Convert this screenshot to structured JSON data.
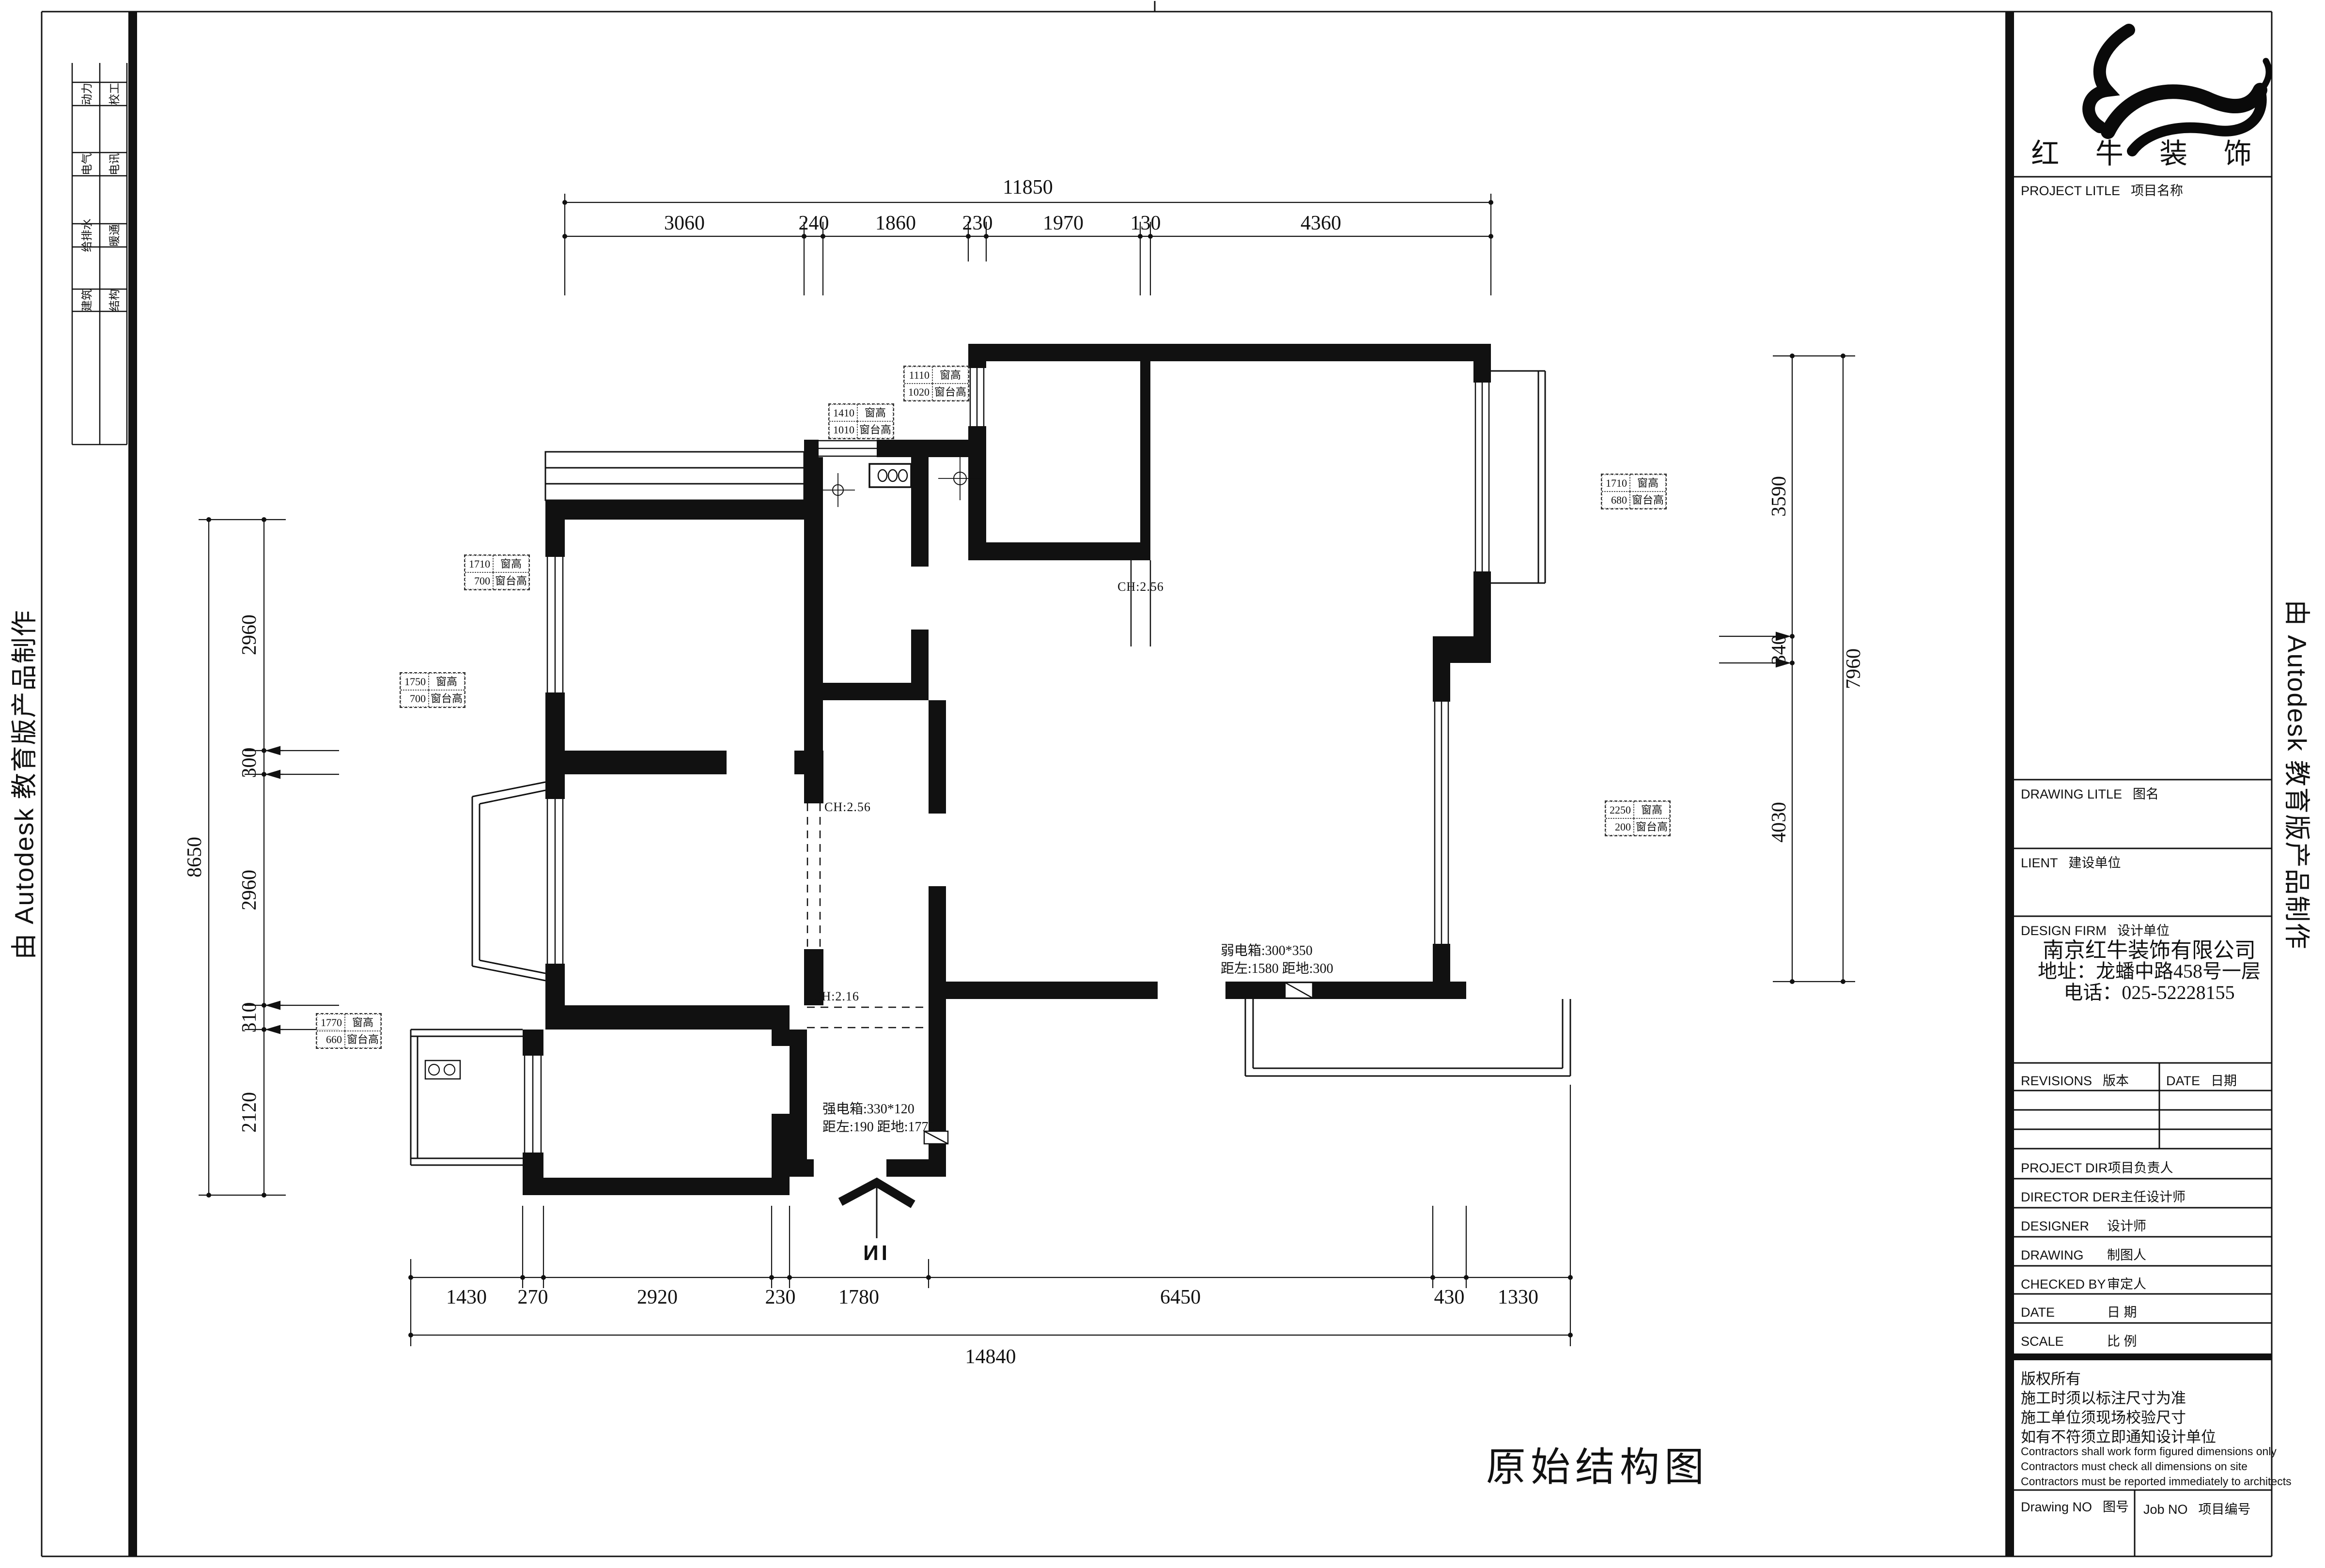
{
  "frame": {
    "autodesk_left": "由 Autodesk 教育版产品制作",
    "autodesk_right": "由 Autodesk 教育版产品制作"
  },
  "margin_stamps": {
    "rows": [
      {
        "left": "动力",
        "right": "校工"
      },
      {
        "left": "电气",
        "right": "电讯"
      },
      {
        "left": "给排水",
        "right": "暖通"
      },
      {
        "left": "建筑",
        "right": "结构"
      }
    ]
  },
  "plan": {
    "title": "原始结构图",
    "entrance_label": "ИI",
    "dims": {
      "top_total": "11850",
      "top": [
        "3060",
        "240",
        "1860",
        "230",
        "1970",
        "130",
        "4360"
      ],
      "left_total": "8650",
      "left": [
        "2960",
        "300",
        "2960",
        "310",
        "2120"
      ],
      "right_total": "7960",
      "right": [
        "3590",
        "340",
        "4030"
      ],
      "bottom_total": "14840",
      "bottom": [
        "1430",
        "270",
        "2920",
        "230",
        "1780",
        "6450",
        "430",
        "1330"
      ]
    },
    "tag_labels": {
      "height": "窗高",
      "sill": "窗台高"
    },
    "window_tags": [
      {
        "height_value": "1410",
        "sill_value": "1010"
      },
      {
        "height_value": "1110",
        "sill_value": "1020"
      },
      {
        "height_value": "1710",
        "sill_value": "680"
      },
      {
        "height_value": "2250",
        "sill_value": "200"
      },
      {
        "height_value": "1710",
        "sill_value": "700"
      },
      {
        "height_value": "1750",
        "sill_value": "700"
      },
      {
        "height_value": "1770",
        "sill_value": "660"
      }
    ],
    "ceiling_labels": [
      "CH:2.56",
      "CH:2.56",
      "CH:2.16"
    ],
    "notes": {
      "weak_box_line1": "弱电箱:300*350",
      "weak_box_line2": "距左:1580 距地:300",
      "strong_box_line1": "强电箱:330*120",
      "strong_box_line2": "距左:190 距地:1770"
    }
  },
  "title_block": {
    "logo_name": "红 牛 装 饰",
    "project_title_en": "PROJECT LITLE",
    "project_title_cn": "项目名称",
    "drawing_title_en": "DRAWING LITLE",
    "drawing_title_cn": "图名",
    "client_en": "LIENT",
    "client_cn": "建设单位",
    "design_firm_en": "DESIGN FIRM",
    "design_firm_cn": "设计单位",
    "firm_name": "南京红牛装饰有限公司",
    "firm_address": "地址：龙蟠中路458号一层",
    "firm_phone": "电话：025-52228155",
    "revisions_en": "REVISIONS",
    "revisions_cn": "版本",
    "date_col_en": "DATE",
    "date_col_cn": "日期",
    "rows": [
      {
        "en": "PROJECT DIR",
        "cn": "项目负责人"
      },
      {
        "en": "DIRECTOR DER",
        "cn": "主任设计师"
      },
      {
        "en": "DESIGNER",
        "cn": "设计师"
      },
      {
        "en": "DRAWING",
        "cn": "制图人"
      },
      {
        "en": "CHECKED BY",
        "cn": "审定人"
      },
      {
        "en": "DATE",
        "cn": "日  期"
      },
      {
        "en": "SCALE",
        "cn": "比  例"
      }
    ],
    "copyright_lines": {
      "l1": "版权所有",
      "l2": "施工时须以标注尺寸为准",
      "l3": "施工单位须现场校验尺寸",
      "l4": "如有不符须立即通知设计单位"
    },
    "contractor_lines": {
      "l1": "Contractors shall work form figured dimensions only",
      "l2": "Contractors must check all dimensions on site",
      "l3": "Contractors must be reported immediately to architects"
    },
    "drawing_no_en": "Drawing NO",
    "drawing_no_cn": "图号",
    "job_no_en": "Job NO",
    "job_no_cn": "项目编号"
  }
}
